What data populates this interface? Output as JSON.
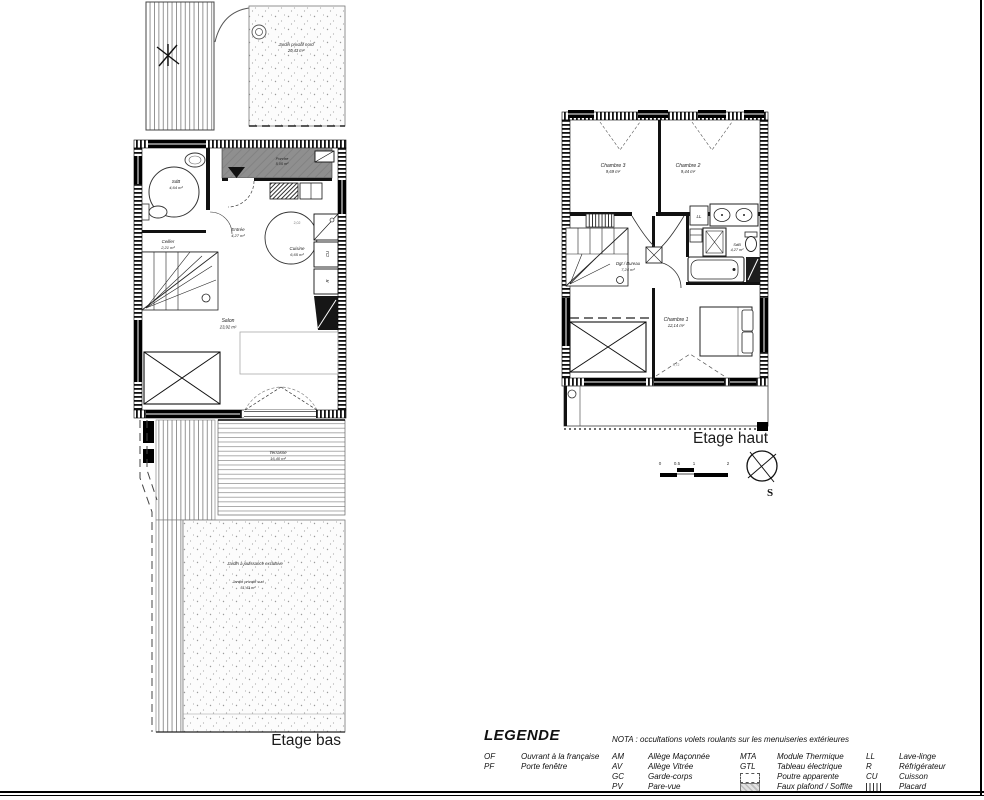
{
  "sheet": {
    "bas_title": "Etage bas",
    "haut_title": "Etage haut"
  },
  "bas": {
    "rooms": {
      "jardin_nord": {
        "name": "Jardin privatif nord",
        "area": "20,43 m²"
      },
      "porche": {
        "name": "Porche",
        "area": "5,05 m²"
      },
      "sdb": {
        "name": "SdB",
        "area": "4,64 m²"
      },
      "cellier": {
        "name": "Cellier",
        "area": "2,21 m²"
      },
      "entree": {
        "name": "Entrée",
        "area": "4,27 m²"
      },
      "cuisine": {
        "name": "Cuisine",
        "area": "6,65 m²"
      },
      "salon": {
        "name": "Salon",
        "area": "23,92 m²"
      },
      "terrasse": {
        "name": "Terrasse",
        "area": "16,40 m²"
      },
      "jardin_exclusif": "Jardin à jouissance exclusive",
      "jardin_sud": {
        "name": "Jardin privatif sud",
        "area": "51,43 m²"
      }
    },
    "appliances": {
      "cuisson": "CU",
      "refrigerateur": "R"
    },
    "dims": {
      "cuisine_width": "2,02"
    }
  },
  "haut": {
    "rooms": {
      "chambre3": {
        "name": "Chambre 3",
        "area": "9,69 m²"
      },
      "chambre2": {
        "name": "Chambre 2",
        "area": "9,44 m²"
      },
      "chambre1": {
        "name": "Chambre 1",
        "area": "12,14 m²"
      },
      "dgt": {
        "name": "Dgt / Bureau",
        "area": "7,24 m²"
      },
      "sdb": {
        "name": "SdB",
        "area": "4,27 m²"
      }
    },
    "appliances": {
      "lave_linge": "LL"
    },
    "compass": {
      "south": "S"
    },
    "scale": {
      "ticks": [
        "0",
        "0.5",
        "1",
        "2"
      ]
    },
    "dims": {
      "chambre1_width": "3,72"
    }
  },
  "legend": {
    "title": "LEGENDE",
    "nota": "NOTA : occultations volets roulants sur les menuiseries extérieures",
    "col1": [
      {
        "abbr": "OF",
        "desc": "Ouvrant à la française"
      },
      {
        "abbr": "PF",
        "desc": "Porte fenêtre"
      }
    ],
    "col2": [
      {
        "abbr": "AM",
        "desc": "Allège Maçonnée"
      },
      {
        "abbr": "AV",
        "desc": "Allège Vitrée"
      },
      {
        "abbr": "GC",
        "desc": "Garde-corps"
      },
      {
        "abbr": "PV",
        "desc": "Pare-vue"
      }
    ],
    "col3": [
      {
        "abbr": "MTA",
        "desc": "Module Thermique"
      },
      {
        "abbr": "GTL",
        "desc": "Tableau électrique"
      },
      {
        "abbr": "",
        "desc": "Poutre apparente"
      },
      {
        "abbr": "",
        "desc": "Faux plafond / Soffite"
      }
    ],
    "col4": [
      {
        "abbr": "LL",
        "desc": "Lave-linge"
      },
      {
        "abbr": "R",
        "desc": "Réfrigérateur"
      },
      {
        "abbr": "CU",
        "desc": "Cuisson"
      },
      {
        "abbr": "",
        "desc": "Placard"
      }
    ]
  }
}
